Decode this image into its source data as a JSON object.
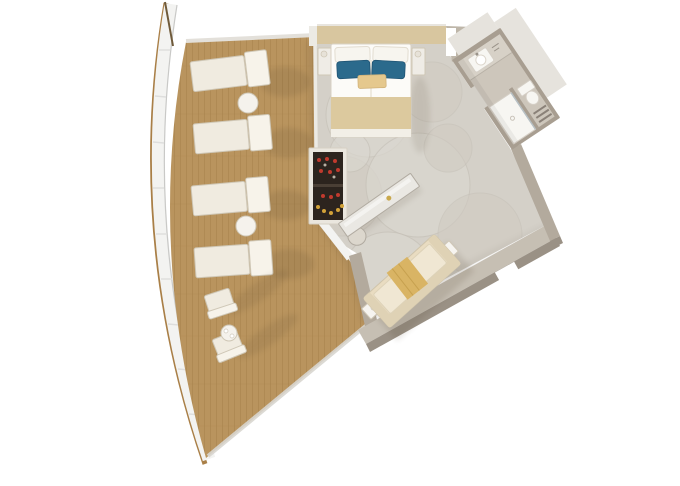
{
  "meta": {
    "view": "top-down 3d floor plan rendering",
    "canvas": {
      "width": 680,
      "height": 486
    }
  },
  "palette": {
    "background": "#ffffff",
    "hull_wood": "#a97f47",
    "hull_spur": "#6f5a3a",
    "rail_white": "#f3f3f1",
    "rail_line": "#c9c9c7",
    "rail_tick": "#dededd",
    "deck_wood": "#b9945e",
    "deck_plank_line": "#a5804a",
    "deck_trim": "#d9d6d0",
    "deck_top_trim": "#e3e0da",
    "lounger_cushion": "#f0ebe0",
    "lounger_back": "#f7f3ea",
    "table_top": "#f5f2ec",
    "carpet": "#d4d0c8",
    "wall_top": "#c6bfb3",
    "wall_side": "#9a9185",
    "wall_taupe": "#b3aa9d",
    "wall_white": "#eceae4",
    "entry_wall": "#beb6a9",
    "headboard": "#d8c69f",
    "bed_white": "#fcfbf8",
    "pillow_white": "#f7f5ef",
    "pillow_blue": "#2b6a8c",
    "bench_tan": "#e5c88d",
    "bed_foot": "#dcc99e",
    "bed_foot_edge": "#f2efe7",
    "nightstand": "#efece6",
    "minibar_frame": "#eae6de",
    "minibar_dark": "#2c241e",
    "minibar_red": "#c03a2e",
    "minibar_yellow": "#d2a238",
    "desk_top": "#eae8e3",
    "desk_inner": "#f4f3f0",
    "desk_gold": "#c9a84c",
    "chair_seat": "#dcd7cd",
    "sofa_base": "#e9dcc1",
    "sofa_back": "#dfd2b5",
    "sofa_cushion": "#f0e7d3",
    "throw_gold": "#d9b464",
    "side_table": "#f6f4f0",
    "bath_wall": "#a89e91",
    "bath_floor": "#cdc6bb",
    "vanity": "#d7d1c7",
    "fixture": "#f7f6f2",
    "glass": "#b7c0c4",
    "slab": "#e6e3dd"
  },
  "scene": {
    "balcony": {
      "floor": "teak-plank-deck",
      "edge": "curved-white-railing",
      "items": [
        {
          "name": "sun-lounger",
          "count": 4
        },
        {
          "name": "round-side-table",
          "count": 2
        },
        {
          "name": "deck-chair",
          "count": 2
        },
        {
          "name": "bistro-table",
          "count": 1
        }
      ]
    },
    "bedroom": {
      "floor": "patterned-carpet",
      "items": [
        {
          "name": "double-bed",
          "count": 1
        },
        {
          "name": "white-pillow",
          "count": 2
        },
        {
          "name": "blue-pillow",
          "count": 2
        },
        {
          "name": "bed-runner",
          "count": 1
        },
        {
          "name": "nightstand",
          "count": 2
        },
        {
          "name": "minibar-cabinet",
          "count": 1
        },
        {
          "name": "writing-desk",
          "count": 1
        },
        {
          "name": "desk-chair",
          "count": 1
        }
      ]
    },
    "bathroom": {
      "items": [
        {
          "name": "vanity-sink",
          "count": 1
        },
        {
          "name": "shower",
          "count": 1
        },
        {
          "name": "toilet",
          "count": 1
        },
        {
          "name": "towel-shelf",
          "count": 1
        }
      ]
    },
    "sitting_area": {
      "items": [
        {
          "name": "sofa",
          "count": 1
        },
        {
          "name": "gold-throw",
          "count": 1
        },
        {
          "name": "side-table",
          "count": 2
        }
      ]
    }
  }
}
